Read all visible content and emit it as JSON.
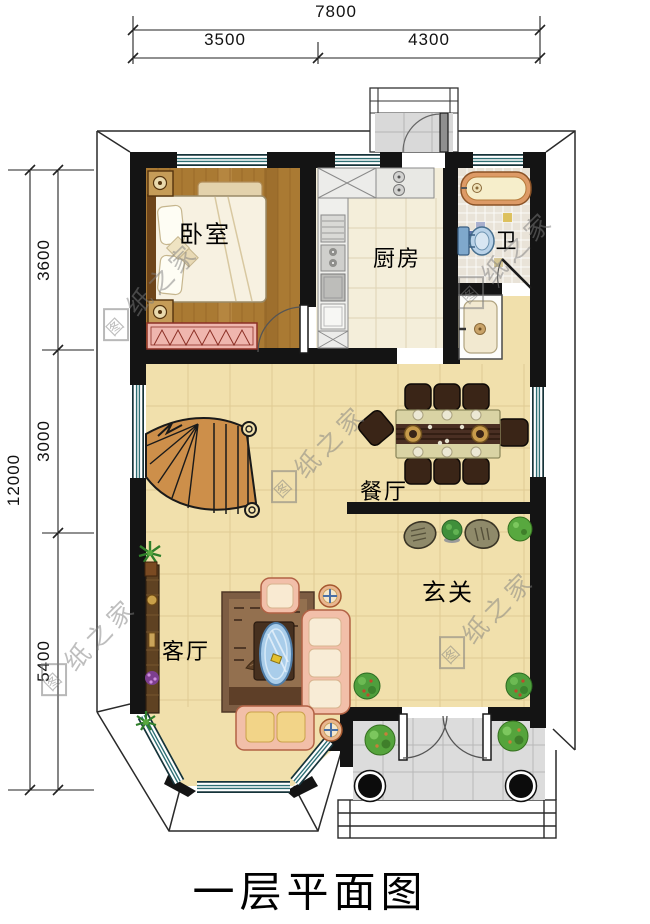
{
  "meta": {
    "title": "一层平面图"
  },
  "dimensions": {
    "top": {
      "total": "7800",
      "segments": [
        "3500",
        "4300"
      ]
    },
    "left": {
      "total": "12000",
      "segments": [
        "3600",
        "3000",
        "5400"
      ]
    }
  },
  "rooms": {
    "bedroom": "卧室",
    "kitchen": "厨房",
    "bath": "卫",
    "dining": "餐厅",
    "foyer": "玄关",
    "living": "客厅"
  },
  "watermark": {
    "logo_char": "图",
    "text": "纸之家",
    "full": "图纸之家"
  },
  "colors": {
    "wall": "#141414",
    "hall_tile": "#f1e0ac",
    "bedroom_wood": "#aa7a33",
    "kitchen_tile": "#f4eeda",
    "bath_mosaic": "#e9e3d8",
    "porch_tile": "#dcdcdc",
    "window_frame": "#2e6f74",
    "stair_wood": "#cd8f4a",
    "sofa_pink": "#f2bfa9",
    "wardrobe_pink": "#efb6ae",
    "table_blue": "#a9cdea"
  }
}
